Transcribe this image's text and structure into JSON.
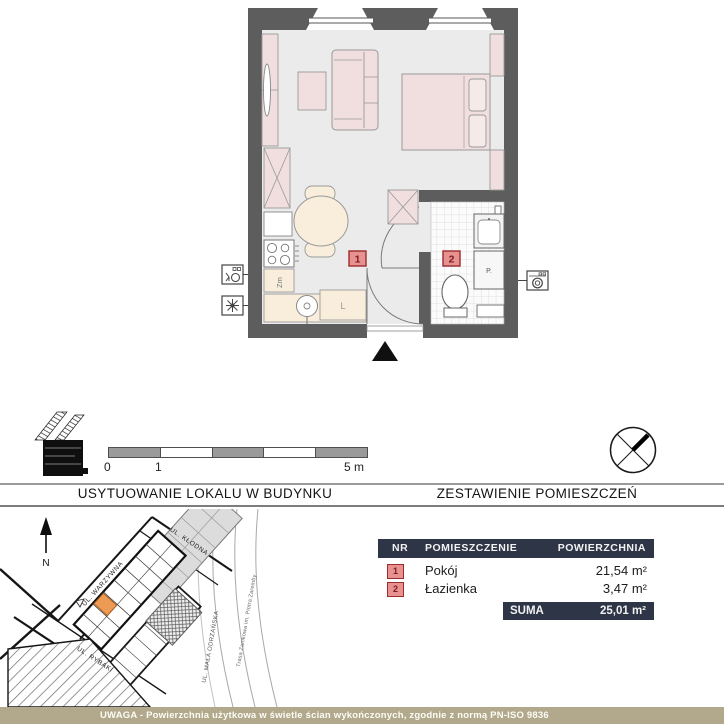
{
  "plan": {
    "marker_room1": "1",
    "marker_room2": "2",
    "label_dishwasher": "Zm",
    "label_fridge": "L",
    "label_washer": "P."
  },
  "scale_bar": {
    "tick_0": "0",
    "tick_1": "1",
    "tick_5": "5 m"
  },
  "headers": {
    "location": "USYTUOWANIE LOKALU W BUDYNKU",
    "rooms": "ZESTAWIENIE POMIESZCZEŃ"
  },
  "site_plan": {
    "north": "N",
    "streets": [
      "UL. KŁODNA",
      "UL. WARZYWNA",
      "UL. RYBAKI",
      "UL. MAŁA ODRZAŃSKA",
      "Trasa Zamkowa im. Piotra Zaremby"
    ]
  },
  "rooms_table": {
    "col_nr": "NR",
    "col_name": "POMIESZCZENIE",
    "col_area": "POWIERZCHNIA",
    "rows": [
      {
        "nr": "1",
        "name": "Pokój",
        "area": "21,54 m²"
      },
      {
        "nr": "2",
        "name": "Łazienka",
        "area": "3,47 m²"
      }
    ],
    "suma_label": "SUMA",
    "suma_value": "25,01 m²"
  },
  "footer": {
    "note": "UWAGA - Powierzchnia użytkowa w świetle ścian wykończonych, zgodnie z normą PN-ISO 9836"
  },
  "colors": {
    "wall": "#5d5d5d",
    "furniture_pink": "#f1dede",
    "kitchen_cream": "#f8eedb",
    "marker_bg": "#e89191",
    "marker_border": "#9c2b2b",
    "table_header_bg": "#2e3547",
    "footer_bg": "#b2a88c",
    "unit_highlight": "#ec9a54"
  }
}
